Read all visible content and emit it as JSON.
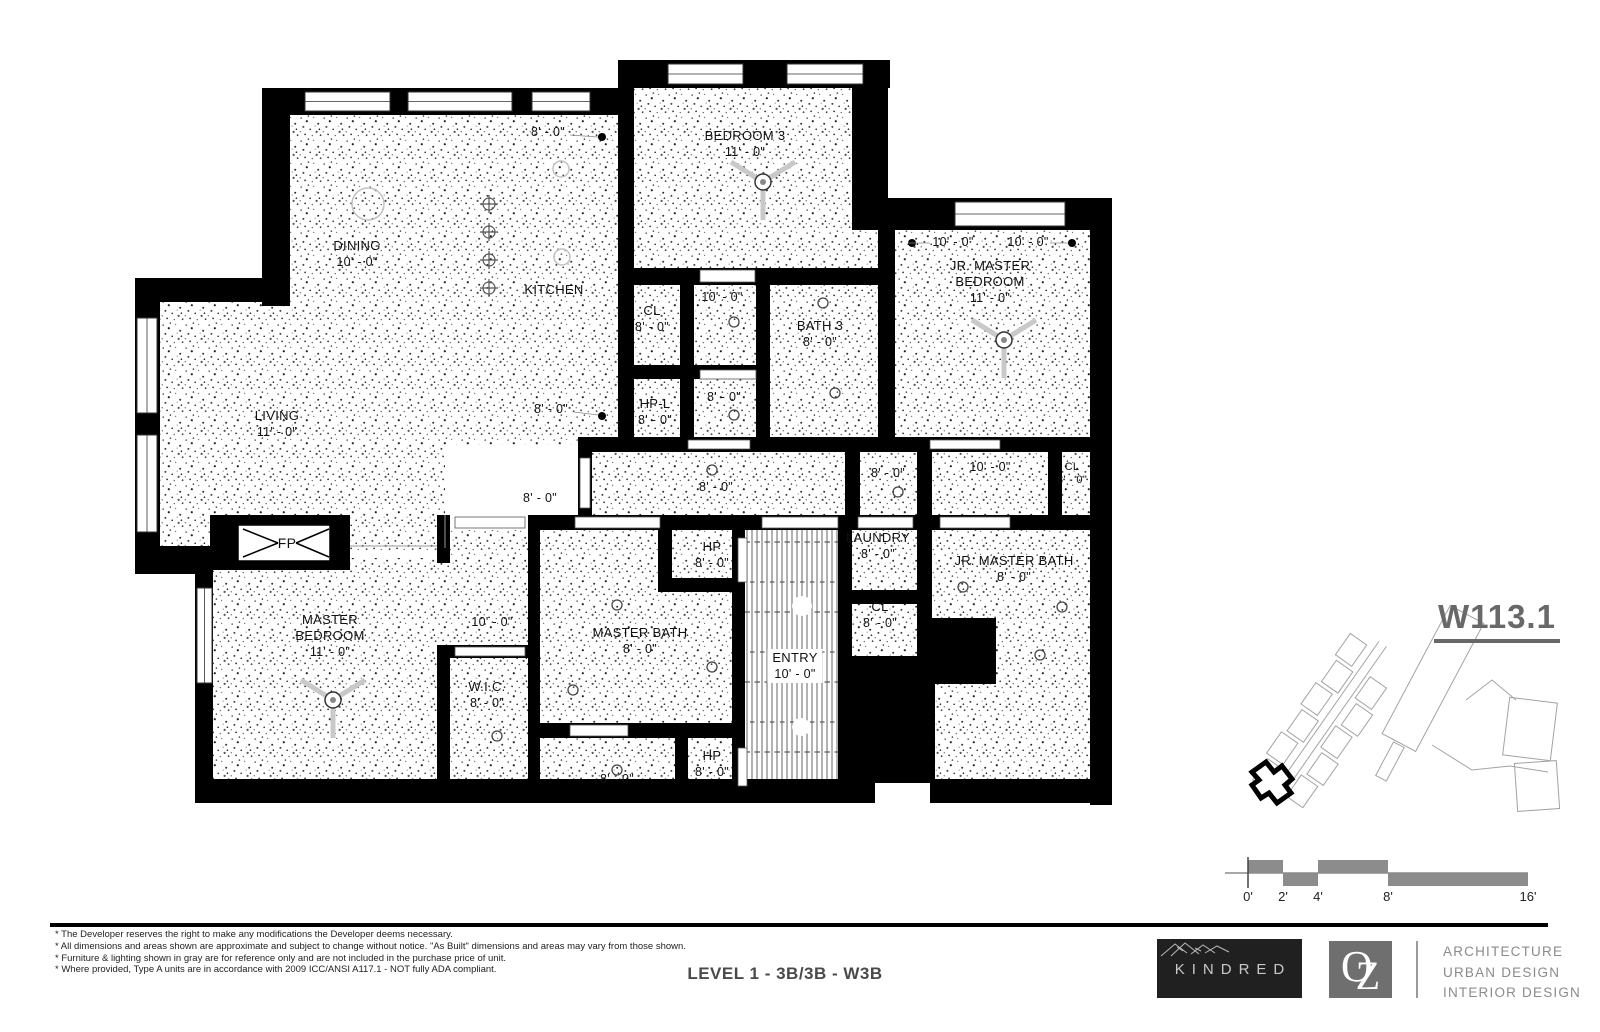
{
  "sheet": {
    "number": "W113.1",
    "label": "LEVEL 1 - 3B/3B - W3B"
  },
  "rooms": {
    "dining": {
      "name": "DINING",
      "dim": "10' - 0\""
    },
    "kitchen": {
      "name": "KITCHEN"
    },
    "bedroom3": {
      "name": "BEDROOM 3",
      "dim": "11' - 0\""
    },
    "cl_upper": {
      "name": "CL",
      "dim": "8' - 0\""
    },
    "bath3": {
      "name": "BATH 3",
      "dim": "8' - 0\""
    },
    "hp_l": {
      "name": "HP-L",
      "dim": "8' - 0\""
    },
    "jr_master_bedroom": {
      "name": "JR. MASTER BEDROOM",
      "dim": "11' - 0\""
    },
    "living": {
      "name": "LIVING",
      "dim": "11' - 0\""
    },
    "laundry": {
      "name": "LAUNDRY",
      "dim": "8' - 0\""
    },
    "cl_right": {
      "name": "CL",
      "dim": "8' - 0\""
    },
    "cl_mid": {
      "name": "CL",
      "dim": "8' - 0\""
    },
    "jr_master_bath": {
      "name": "JR. MASTER BATH",
      "dim": "8' - 0\""
    },
    "master_bedroom": {
      "name": "MASTER BEDROOM",
      "dim": "11' - 0\""
    },
    "wic": {
      "name": "W.I.C.",
      "dim": "8' - 0\""
    },
    "master_bath": {
      "name": "MASTER BATH",
      "dim": "8' - 0\""
    },
    "hp_top": {
      "name": "HP",
      "dim": "8' - 0\""
    },
    "hp_bottom": {
      "name": "HP",
      "dim": "8' - 0\""
    },
    "entry": {
      "name": "ENTRY",
      "dim": "10' - 0\""
    },
    "fireplace": {
      "name": "FP"
    }
  },
  "dims": {
    "k_top": "8' - 0\"",
    "k_left": "8' - 0\"",
    "hall_upper": "10' - 0\"",
    "room_mid": "8' - 0\"",
    "jr_left": "10' - 0\"",
    "jr_right": "10' - 0\"",
    "corridor": "8' - 0\"",
    "corridor_left": "8' - 0\"",
    "nook": "8' - 0\"",
    "corridor_right": "10' - 0\"",
    "vestibule": "10' - 0\"",
    "toilet": "8' - 0\""
  },
  "scale_bar": {
    "labels": [
      "0'",
      "2'",
      "4'",
      "8'",
      "16'"
    ]
  },
  "notes": [
    "* The Developer reserves the right to make any modifications the Developer deems necessary.",
    "* All dimensions and areas shown are approximate and subject to change without notice. \"As Built\" dimensions and areas may vary from those shown.",
    "* Furniture & lighting shown in gray are for reference only and are not included in the purchase price of unit.",
    "* Where provided, Type A units are in accordance with 2009 ICC/ANSI A117.1 - NOT fully ADA compliant."
  ],
  "brand": {
    "kindred": "KINDRED",
    "oz_o": "O",
    "oz_z": "Z",
    "services": [
      "ARCHITECTURE",
      "URBAN DESIGN",
      "INTERIOR DESIGN"
    ]
  }
}
